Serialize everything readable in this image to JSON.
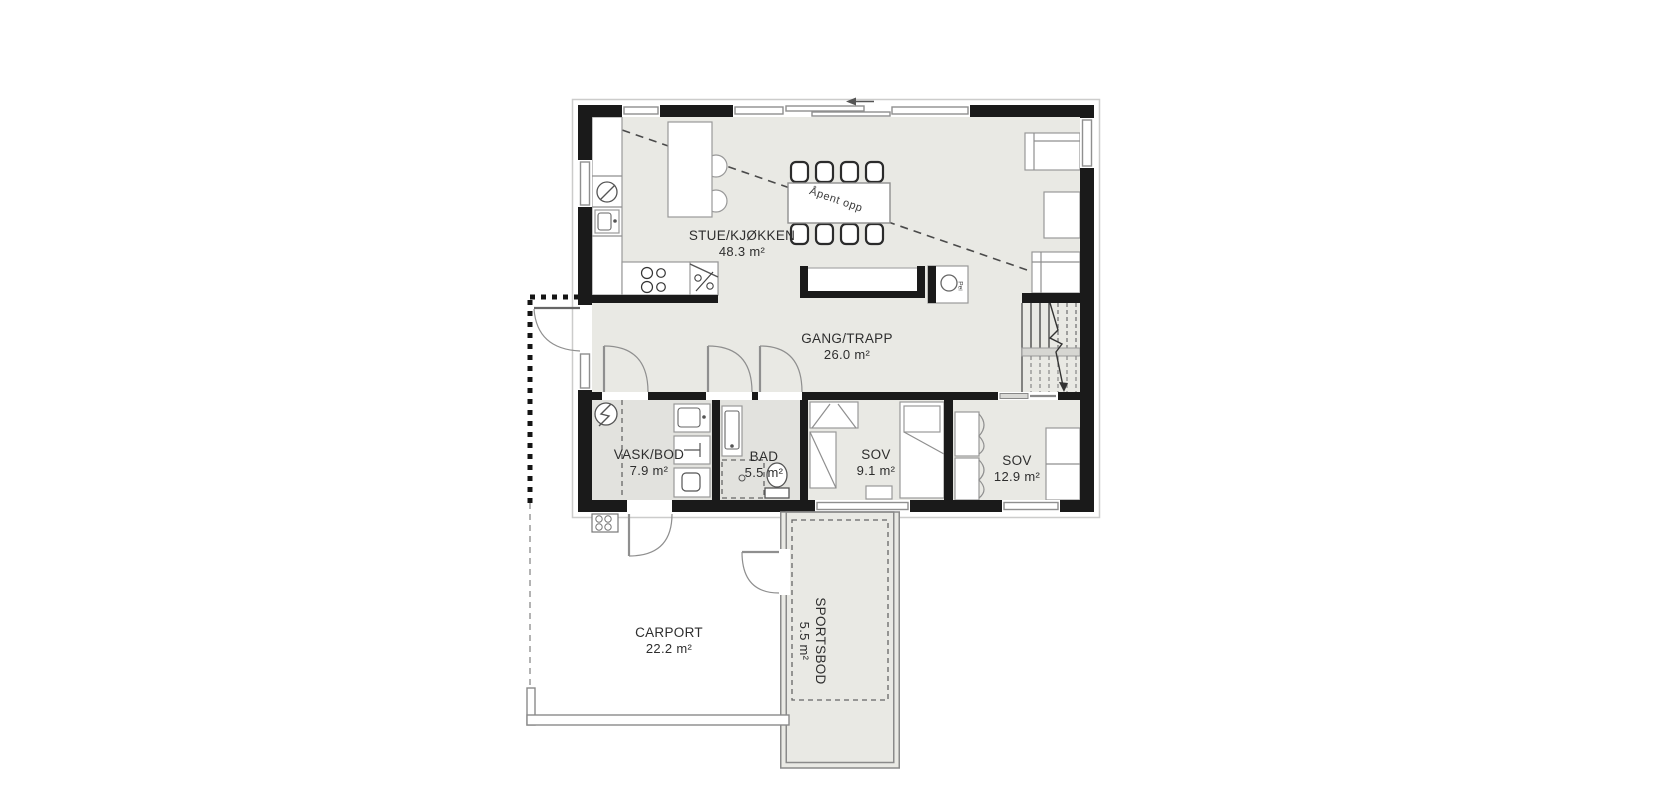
{
  "plan": {
    "colors": {
      "wall": "#1a1a1a",
      "floor": "#e9e9e4",
      "floor_wet": "#e2e2de",
      "line": "#8f8f8f",
      "text": "#2e2e2e"
    },
    "annotations": {
      "open_above": "Åpent opp",
      "fireplace": "Pei"
    },
    "rooms": {
      "stue": {
        "name": "STUE/KJØKKEN",
        "area": "48.3 m²"
      },
      "gang": {
        "name": "GANG/TRAPP",
        "area": "26.0 m²"
      },
      "vask": {
        "name": "VASK/BOD",
        "area": "7.9 m²"
      },
      "bad": {
        "name": "BAD",
        "area": "5.5 m²"
      },
      "sov1": {
        "name": "SOV",
        "area": "9.1 m²"
      },
      "sov2": {
        "name": "SOV",
        "area": "12.9 m²"
      },
      "carport": {
        "name": "CARPORT",
        "area": "22.2 m²"
      },
      "sportsbod": {
        "name": "SPORTSBOD",
        "area": "5.5 m²"
      }
    }
  }
}
